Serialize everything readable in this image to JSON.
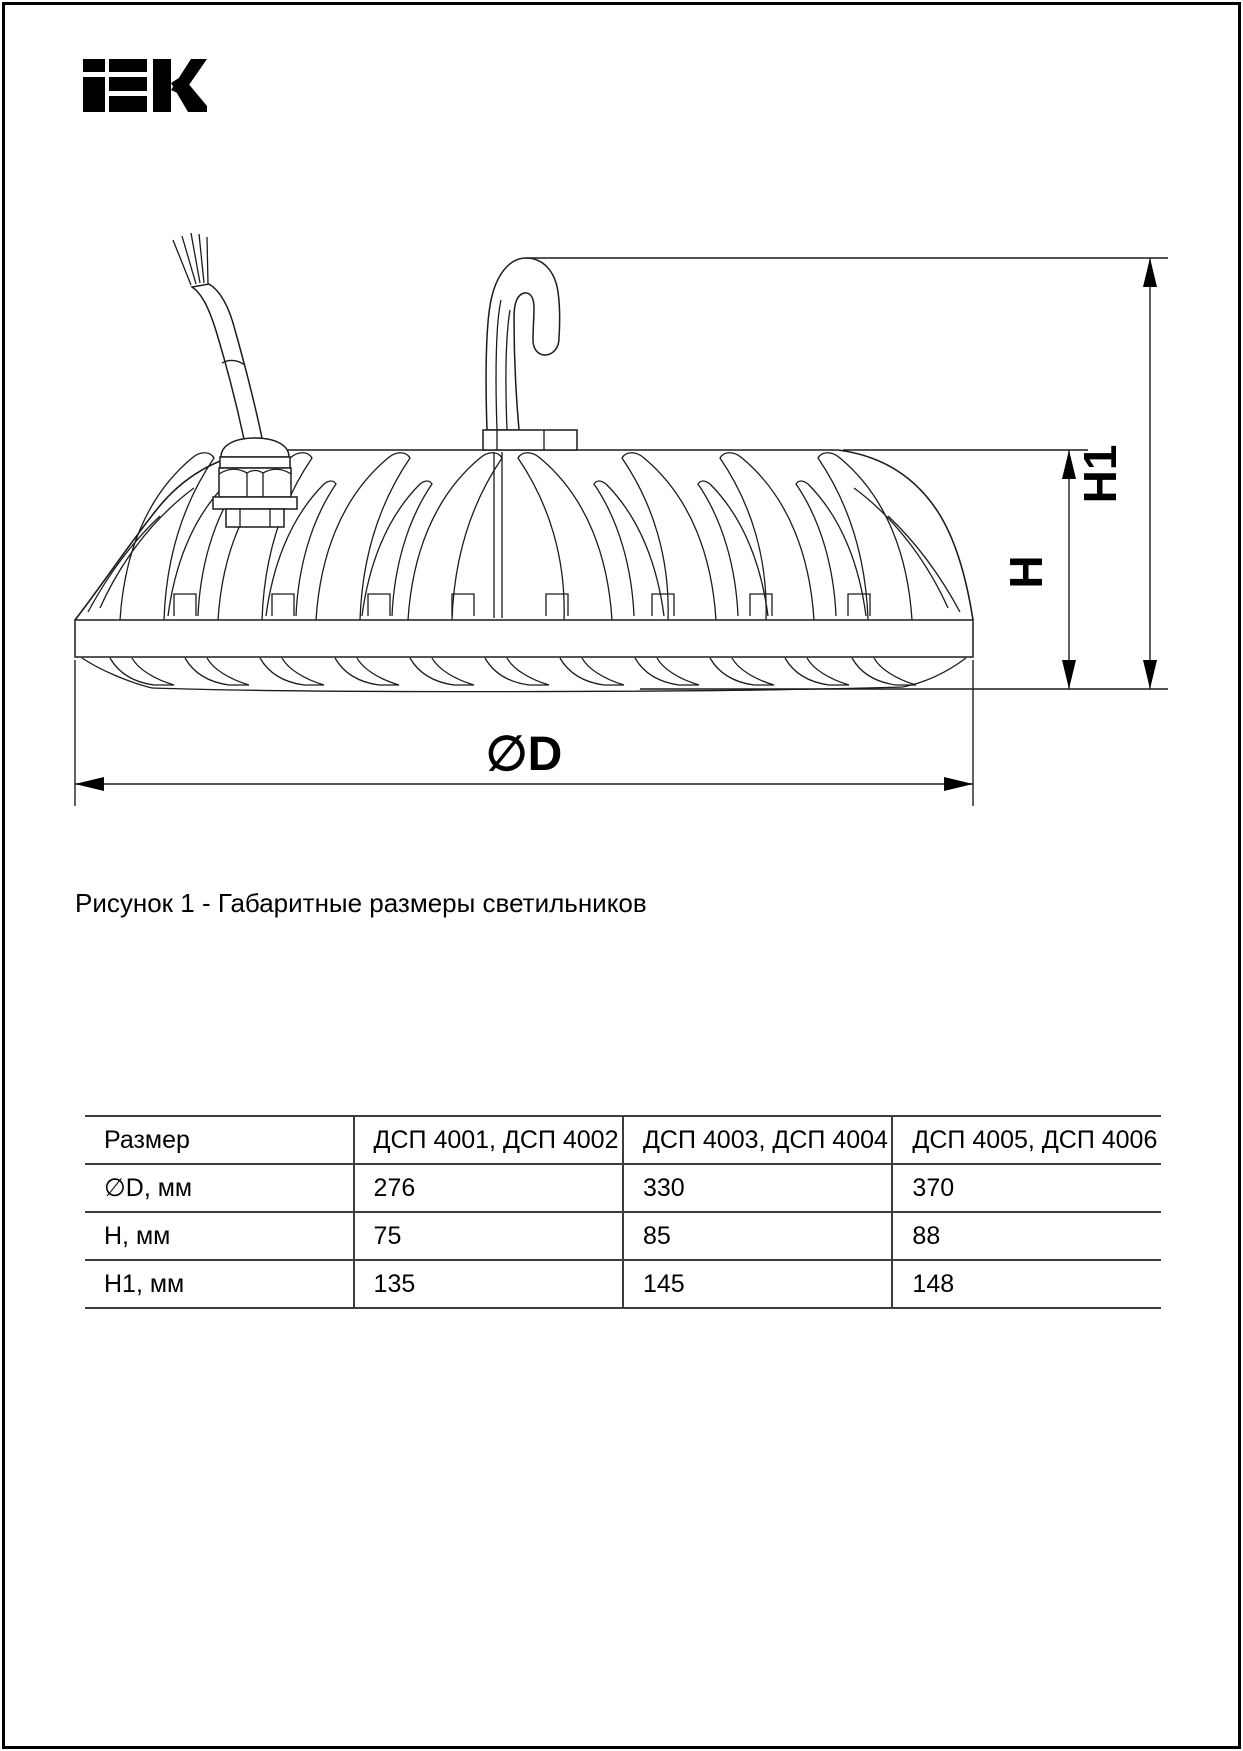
{
  "logo": {
    "name": "iek-logo",
    "alt": "IEK"
  },
  "figure": {
    "caption": "Рисунок 1 - Габаритные размеры светильников",
    "labels": {
      "diameter": "∅D",
      "height": "H",
      "total_height": "H1"
    }
  },
  "table": {
    "headers": [
      "Размер",
      "ДСП 4001, ДСП 4002",
      "ДСП 4003, ДСП 4004",
      "ДСП 4005, ДСП 4006"
    ],
    "rows": [
      [
        "∅D, мм",
        "276",
        "330",
        "370"
      ],
      [
        "H, мм",
        "75",
        "85",
        "88"
      ],
      [
        "H1, мм",
        "135",
        "145",
        "148"
      ]
    ]
  },
  "colors": {
    "line": "#1c1c1c",
    "page_border": "#000000",
    "table_line": "#3c3c3c"
  }
}
